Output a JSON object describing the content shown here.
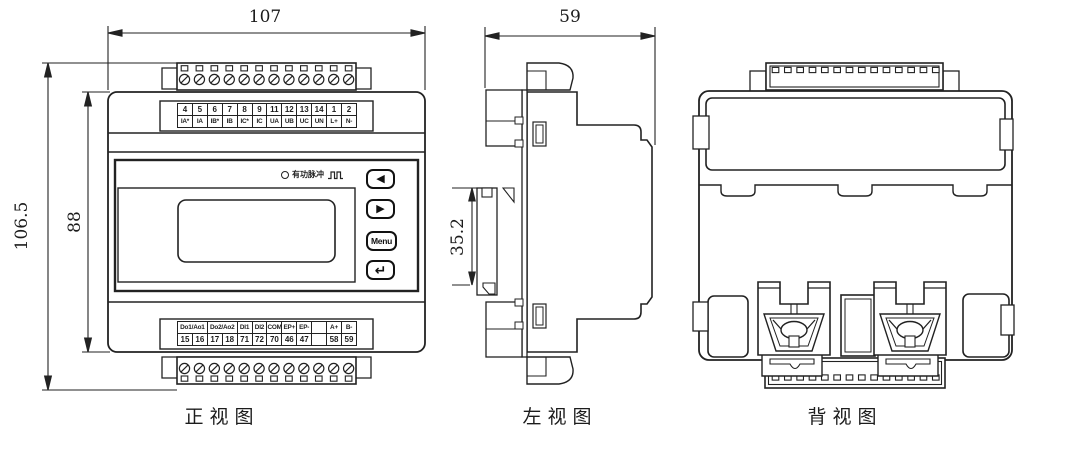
{
  "front": {
    "caption": "正视图",
    "dim_width": "107",
    "dim_total_height": "106.5",
    "dim_body_height": "88",
    "led_label": "有功脉冲",
    "top_terminals": {
      "numbers": [
        "4",
        "5",
        "6",
        "7",
        "8",
        "9",
        "11",
        "12",
        "13",
        "14",
        "1",
        "2"
      ],
      "labels": [
        "IA*",
        "IA",
        "IB*",
        "IB",
        "IC*",
        "IC",
        "UA",
        "UB",
        "UC",
        "UN",
        "L+",
        "N-"
      ]
    },
    "bottom_terminals": {
      "labels": [
        "Do1/Ao1",
        "Do2/Ao2",
        "DI1",
        "DI2",
        "COM",
        "EP+",
        "EP-",
        "",
        "A+",
        "B-"
      ],
      "numbers": [
        "15",
        "16",
        "17",
        "18",
        "71",
        "72",
        "70",
        "46",
        "47",
        "",
        "58",
        "59"
      ]
    },
    "buttons": {
      "prev": "◀",
      "next": "▶",
      "menu": "Menu",
      "enter": "↵"
    }
  },
  "left_view": {
    "caption": "左视图",
    "dim_depth": "59",
    "dim_clip": "35.2"
  },
  "back_view": {
    "caption": "背视图"
  },
  "colors": {
    "line": "#222222",
    "bg": "#ffffff"
  }
}
